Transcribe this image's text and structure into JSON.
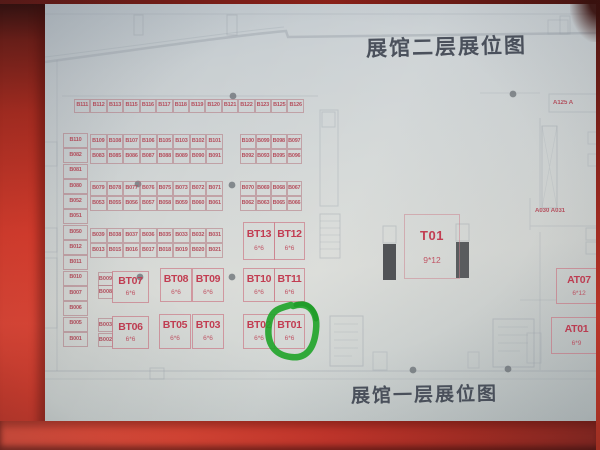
{
  "titles": {
    "floor2": "展馆二层展位图",
    "floor1": "展馆一层展位图"
  },
  "grid": {
    "top_row": [
      "B111",
      "B112",
      "B113",
      "B115",
      "B116",
      "B117",
      "B118",
      "B119",
      "B120",
      "B121",
      "B122",
      "B123",
      "B125",
      "B126"
    ],
    "left_column": [
      "B110",
      "B082",
      "B081",
      "B080",
      "B052",
      "B051",
      "B050",
      "B012",
      "B011",
      "B010",
      "B007",
      "B006",
      "B005",
      "B001"
    ],
    "rows": [
      {
        "left": [
          "B109",
          "B108",
          "B107",
          "B106",
          "B105",
          "B103",
          "B102",
          "B101"
        ],
        "right": [
          "B100",
          "B099",
          "B098",
          "B097"
        ]
      },
      {
        "left": [
          "B083",
          "B085",
          "B086",
          "B087",
          "B088",
          "B089",
          "B090",
          "B091"
        ],
        "right": [
          "B092",
          "B093",
          "B095",
          "B096"
        ]
      },
      {
        "left": [
          "B079",
          "B078",
          "B077",
          "B076",
          "B075",
          "B073",
          "B072",
          "B071"
        ],
        "right": [
          "B070",
          "B069",
          "B068",
          "B067"
        ]
      },
      {
        "left": [
          "B053",
          "B055",
          "B056",
          "B057",
          "B058",
          "B059",
          "B060",
          "B061"
        ],
        "right": [
          "B062",
          "B063",
          "B065",
          "B066"
        ]
      },
      {
        "left": [
          "B039",
          "B038",
          "B037",
          "B036",
          "B035",
          "B033",
          "B032",
          "B031"
        ],
        "right": []
      },
      {
        "left": [
          "B013",
          "B015",
          "B016",
          "B017",
          "B018",
          "B019",
          "B020",
          "B021"
        ],
        "right": []
      }
    ],
    "side_cells": {
      "b009": "B009",
      "b008": "B008",
      "b003": "B003",
      "b002": "B002"
    }
  },
  "big_booths": {
    "bt13": {
      "label": "BT13",
      "size": "6*6"
    },
    "bt12": {
      "label": "BT12",
      "size": "6*6"
    },
    "bt07": {
      "label": "BT07",
      "size": "6*6"
    },
    "bt08": {
      "label": "BT08",
      "size": "6*6"
    },
    "bt09": {
      "label": "BT09",
      "size": "6*6"
    },
    "bt10": {
      "label": "BT10",
      "size": "6*6"
    },
    "bt11": {
      "label": "BT11",
      "size": "6*6"
    },
    "bt06": {
      "label": "BT06",
      "size": "6*6"
    },
    "bt05": {
      "label": "BT05",
      "size": "6*6"
    },
    "bt03": {
      "label": "BT03",
      "size": "6*6"
    },
    "bt02": {
      "label": "BT02",
      "size": "6*6"
    },
    "bt01": {
      "label": "BT01",
      "size": "6*6"
    },
    "t01": {
      "label": "T01",
      "size": "9*12"
    },
    "at07": {
      "label": "AT07",
      "size": "6*12"
    },
    "at01": {
      "label": "AT01",
      "size": "6*9"
    }
  },
  "side_labels": {
    "a125": "A125 A",
    "a030_a031": "A030 A031"
  },
  "annotation": {
    "highlighted_booth": "BT01",
    "marker_color": "#23a52d"
  },
  "colors": {
    "frame_red": "#d83b2b",
    "paper": "#d2d6d5",
    "booth_text": "#b5505e",
    "big_booth_text": "#c23d52",
    "title_text": "#4b515c",
    "marker_green": "#23a52d"
  }
}
